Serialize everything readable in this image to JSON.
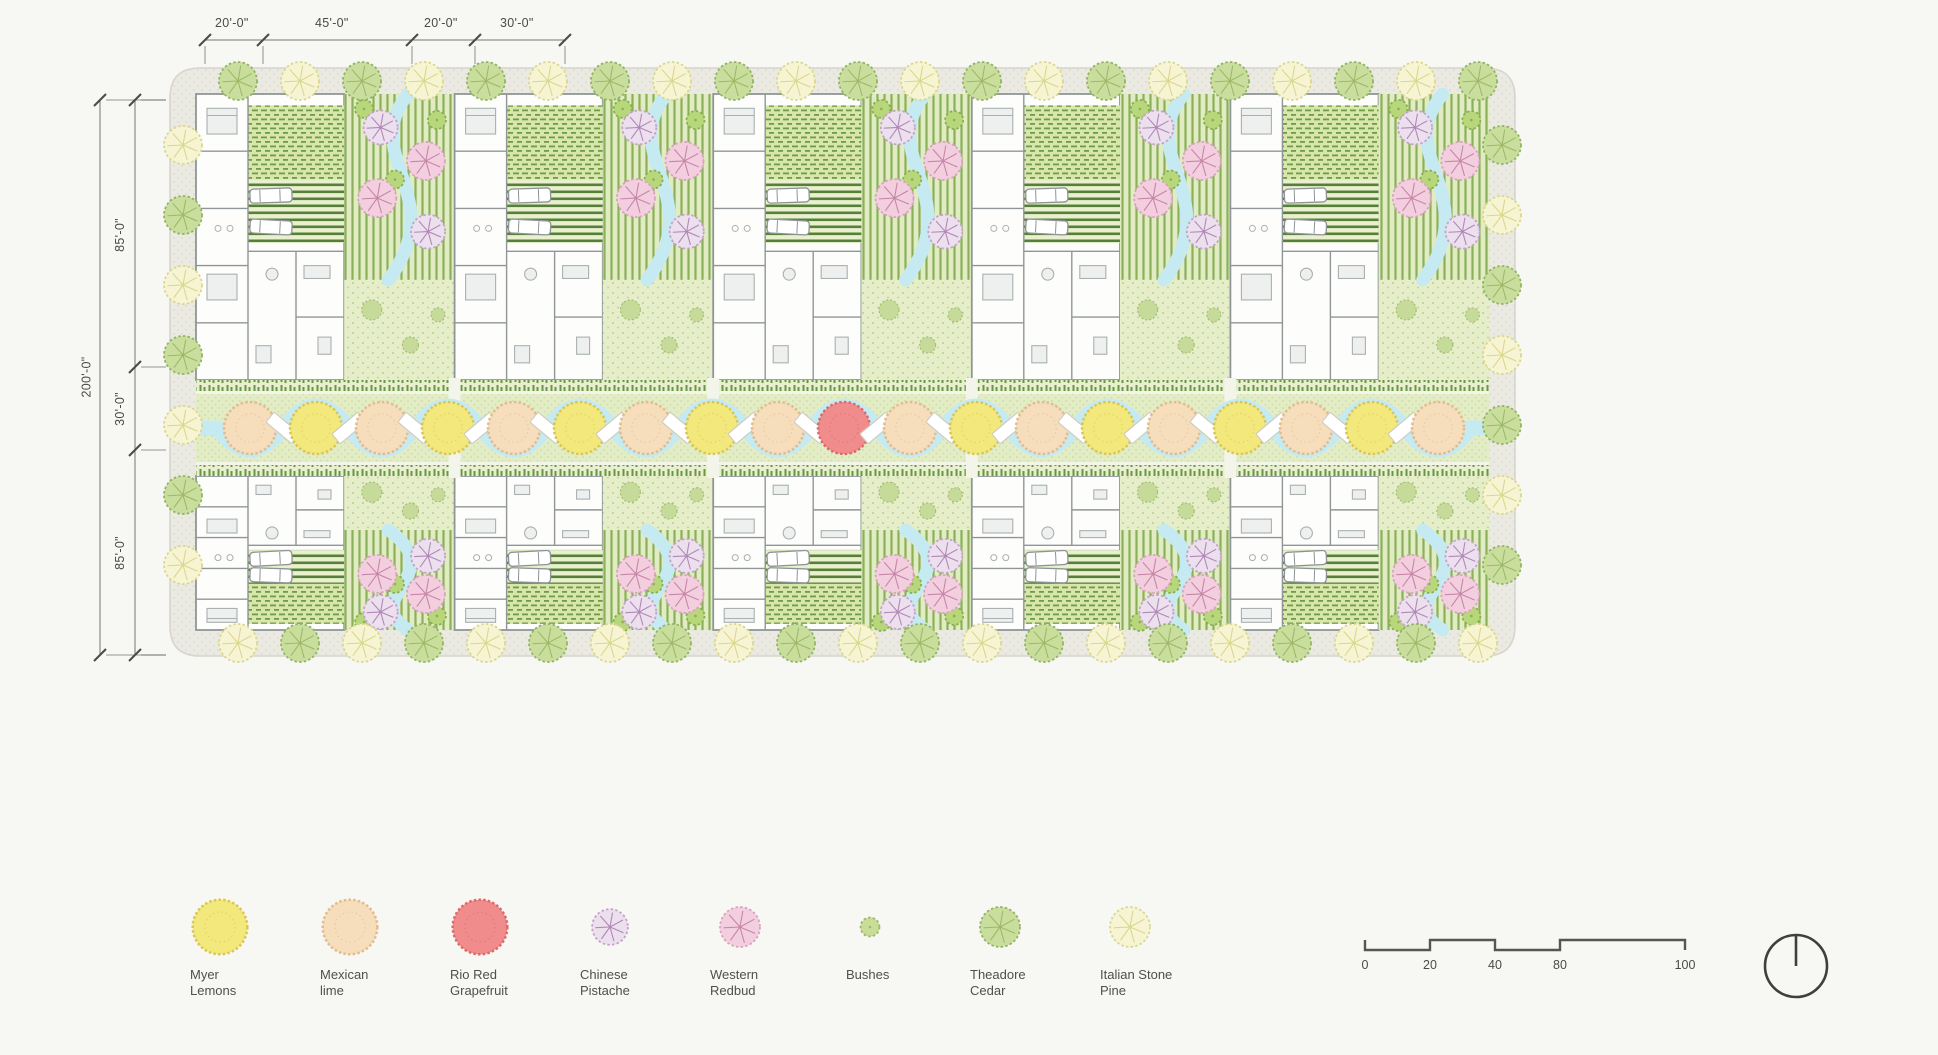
{
  "page": {
    "background": "#f7f7f4"
  },
  "dimensions": {
    "top": [
      "20'-0\"",
      "45'-0\"",
      "20'-0\"",
      "30'-0\""
    ],
    "left_overall": "200'-0\"",
    "left_segments": [
      "85'-0\"",
      "30'-0\"",
      "85'-0\""
    ]
  },
  "legend": {
    "items": [
      {
        "tree": "myer-lemon",
        "label": "Myer Lemons"
      },
      {
        "tree": "mexican-lime",
        "label": "Mexican lime"
      },
      {
        "tree": "rio-red-grapefruit",
        "label": "Rio Red Grapefruit"
      },
      {
        "tree": "chinese-pistache",
        "label": "Chinese Pistache"
      },
      {
        "tree": "western-redbud",
        "label": "Western Redbud"
      },
      {
        "tree": "bushes",
        "label": "Bushes"
      },
      {
        "tree": "theadore-cedar",
        "label": "Theadore Cedar"
      },
      {
        "tree": "italian-stone-pine",
        "label": "Italian Stone Pine"
      }
    ]
  },
  "scale_bar": {
    "labels": [
      "0",
      "20",
      "40",
      "80",
      "100"
    ]
  },
  "trees": {
    "myer-lemon": {
      "fill": "#f3e87c",
      "edge": "#d9c653",
      "r": 26,
      "style": "fluff"
    },
    "mexican-lime": {
      "fill": "#f6ddbb",
      "edge": "#e2bc8d",
      "r": 26,
      "style": "fluff"
    },
    "rio-red-grapefruit": {
      "fill": "#f18c8c",
      "edge": "#dc6a6a",
      "r": 26,
      "style": "fluff"
    },
    "chinese-pistache": {
      "fill": "#ecdfee",
      "edge": "#c5a3c9",
      "spokes": "#b288b7",
      "r": 17,
      "style": "spoke"
    },
    "western-redbud": {
      "fill": "#f3cede",
      "edge": "#d9a2c0",
      "spokes": "#c687a8",
      "r": 19,
      "style": "spoke"
    },
    "bushes": {
      "fill": "#c9dc98",
      "edge": "#9cb96a",
      "r": 9,
      "style": "dot"
    },
    "theadore-cedar": {
      "fill": "#c9de9c",
      "edge": "#93b464",
      "spokes": "#9cb96a",
      "r": 19,
      "style": "spoke"
    },
    "italian-stone-pine": {
      "fill": "#f6f4d3",
      "edge": "#dbd78e",
      "spokes": "#dbd78e",
      "r": 19,
      "style": "spoke"
    },
    "small-green": {
      "fill": "#b8d77b",
      "edge": "#8aaf52",
      "r": 9,
      "style": "dot"
    }
  },
  "plan": {
    "site": {
      "x": 170,
      "y": 68,
      "w": 1345,
      "h": 588,
      "corner_radius": 30,
      "walk": 26
    },
    "rows": {
      "top": {
        "y": 94,
        "h": 286,
        "mirror": false
      },
      "bottom": {
        "y": 476,
        "h": 154,
        "mirror": true
      }
    },
    "modules_per_row": 5,
    "module": {
      "inner_left": 196,
      "inner_right": 1489,
      "house_frac": 0.573
    },
    "band": {
      "y": 392,
      "h": 72,
      "center_y": 428,
      "tree_r": 26,
      "tree_spacing": 66,
      "tree_start_x": 250,
      "trees": [
        "mexican-lime",
        "myer-lemon",
        "mexican-lime",
        "myer-lemon",
        "mexican-lime",
        "myer-lemon",
        "mexican-lime",
        "myer-lemon",
        "mexican-lime",
        "rio-red-grapefruit",
        "mexican-lime",
        "myer-lemon",
        "mexican-lime",
        "myer-lemon",
        "mexican-lime",
        "myer-lemon",
        "mexican-lime",
        "myer-lemon",
        "mexican-lime"
      ]
    },
    "hedges": [
      {
        "y": 380,
        "h": 12
      },
      {
        "y": 464,
        "h": 12
      }
    ],
    "perimeter": {
      "top_bottom": {
        "start_x": 238,
        "spacing": 62,
        "count": 21,
        "sequence": [
          "theadore-cedar",
          "italian-stone-pine"
        ]
      },
      "sides": {
        "start_y": 145,
        "spacing": 70,
        "count": 7,
        "sequence": [
          "italian-stone-pine",
          "theadore-cedar"
        ]
      }
    },
    "garden_trees": [
      {
        "dx": 0.33,
        "dy": 0.18,
        "type": "chinese-pistache"
      },
      {
        "dx": 0.74,
        "dy": 0.36,
        "type": "western-redbud"
      },
      {
        "dx": 0.3,
        "dy": 0.56,
        "type": "western-redbud"
      },
      {
        "dx": 0.76,
        "dy": 0.74,
        "type": "chinese-pistache"
      }
    ],
    "garden_small_trees": [
      {
        "dx": 0.18,
        "dy": 0.08
      },
      {
        "dx": 0.84,
        "dy": 0.14
      },
      {
        "dx": 0.46,
        "dy": 0.46
      }
    ],
    "colors": {
      "walkway_fill": "#ebeae2",
      "walkway_stroke": "#d7d5cc",
      "walkway_dot": "#dbd8cf",
      "site_fill": "#eef2db",
      "stripe_bg": "#e2ecc2",
      "stripe_line": "#8ab05c",
      "meadow_bg": "#e6eec9",
      "meadow_dot": "#b9cf90",
      "orchard_bg": "#d8e6ac",
      "orchard_line": "#6f9c48",
      "drive_bg": "#e9f0cd",
      "drive_line": "#567f3a",
      "stream": "#c5eaf2",
      "hedge": "#679645",
      "hedge_bg": "#e8efce",
      "band_bg": "#e3edc5",
      "band_dot": "#ccd9a3",
      "band_path": "#f4f5ea",
      "wall": "#909697",
      "room_fill": "#fdfdfb",
      "furn_stroke": "#a9b0b0",
      "furn_fill": "#eef0f0",
      "bench_fill": "#ffffff",
      "bench_stroke": "#cfccc2",
      "car_fill": "#ffffff",
      "car_stroke": "#8e9494",
      "dim": "#4a4a4a"
    }
  }
}
